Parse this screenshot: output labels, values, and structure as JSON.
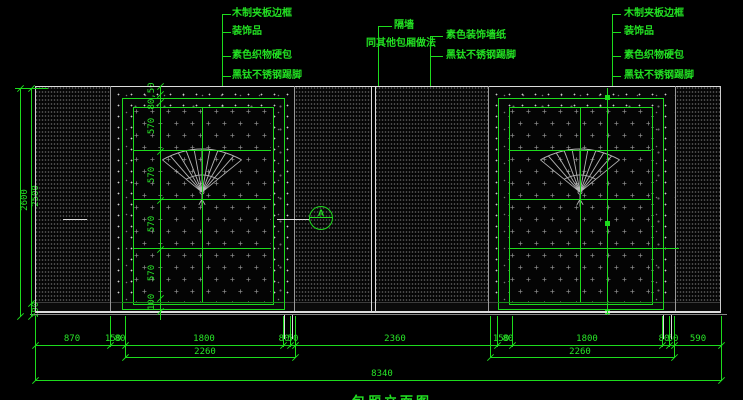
{
  "labels": {
    "left": [
      "木制夹板边框",
      "装饰品",
      "素色织物硬包",
      "黑钛不锈钢踢脚"
    ],
    "middle": {
      "partition_line1": "隔墙",
      "partition_line2": "同其他包厢做法",
      "wallpaper": "素色装饰墙纸",
      "skirting": "黑钛不锈钢踢脚"
    },
    "right": [
      "木制夹板边框",
      "装饰品",
      "素色织物硬包",
      "黑钛不锈钢踢脚"
    ]
  },
  "dims": {
    "height_total": "2600",
    "height_upper": "2500",
    "height_skirting": "100",
    "door_top": "80,50",
    "door_rows": [
      "570",
      "570",
      "570",
      "570"
    ],
    "door_bottom": "100",
    "row1": [
      "870",
      "150",
      "80",
      "1800",
      "80",
      "50",
      "2360",
      "150",
      "80",
      "1800",
      "80",
      "50",
      "590"
    ],
    "row2_left": "2260",
    "row2_right": "2260",
    "total_width": "8340"
  },
  "marker_a": "A",
  "title": "包厢立面图",
  "colors": {
    "background": "#000000",
    "cad_green": "#1ddb1d",
    "line_white": "#dddddd",
    "texture_gray": "#9a9a9a"
  }
}
